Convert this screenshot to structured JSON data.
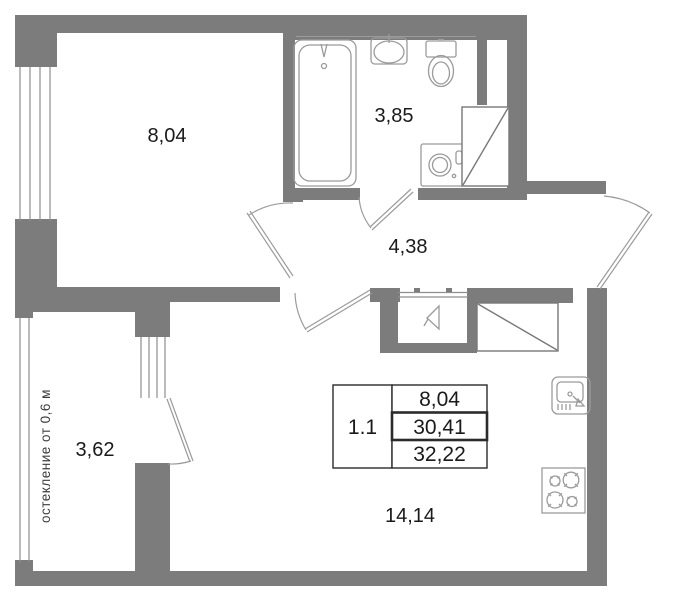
{
  "plan": {
    "title": "apartment-floor-plan",
    "rooms": [
      {
        "id": "bedroom",
        "area_label": "8,04"
      },
      {
        "id": "bathroom",
        "area_label": "3,85"
      },
      {
        "id": "hall",
        "area_label": "4,38"
      },
      {
        "id": "balcony",
        "area_label": "3,62"
      },
      {
        "id": "kitchen-living",
        "area_label": "14,14"
      }
    ],
    "info_table": {
      "unit_label": "1.1",
      "rows": [
        "8,04",
        "30,41",
        "32,22"
      ]
    },
    "note_vertical": "остекление от 0,6 м",
    "fixtures": [
      "bathtub",
      "washbasin",
      "toilet",
      "washing-machine",
      "shower-box",
      "entrance-marker",
      "wardrobe",
      "kitchen-sink",
      "stove"
    ],
    "colors": {
      "wall": "#7c7c7c",
      "fixture_line": "#9b9b9b",
      "window_line": "#8e8e8e",
      "text": "#1a1a1a"
    }
  }
}
